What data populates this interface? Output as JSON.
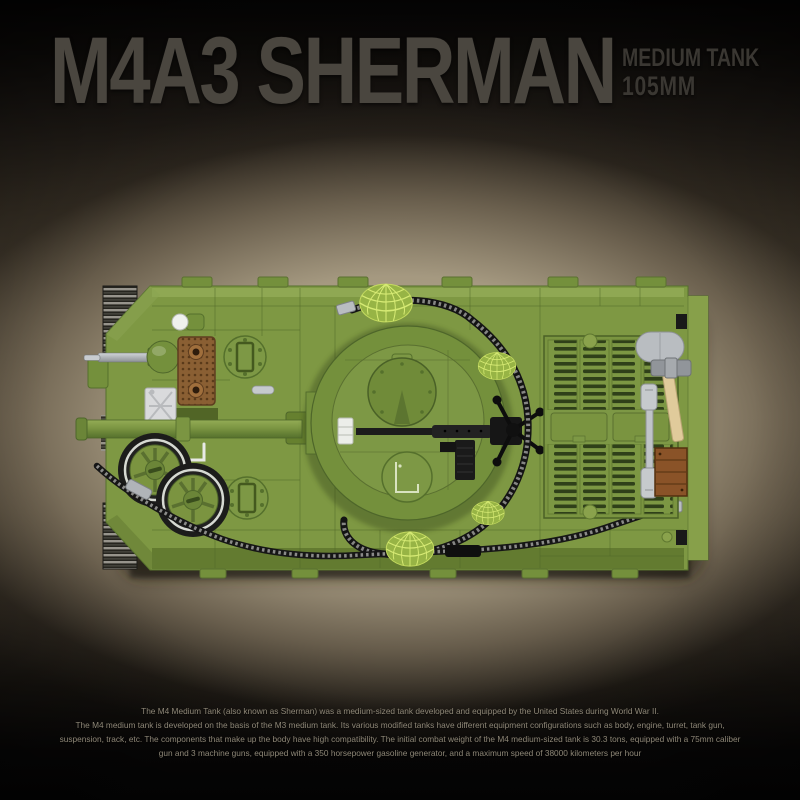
{
  "header": {
    "title": "M4A3 SHERMAN",
    "subtitle_line1": "MEDIUM TANK",
    "subtitle_line2": "105MM"
  },
  "description": {
    "lines": [
      "The M4 Medium Tank (also known as Sherman) was a medium-sized tank developed and equipped by the United States during World War II.",
      "The M4 medium tank is developed on the basis of the M3 medium tank. Its various modified tanks have different equipment configurations such as body, engine, turret, tank gun,",
      "suspension, track, etc. The components that make up the body have high compatibility. The initial combat weight of the M4 medium-sized tank is 30.3 tons, equipped with a 75mm caliber",
      "gun and 3 machine guns, equipped with a 350 horsepower gasoline generator, and a maximum speed of 38000 kilometers per hour"
    ]
  },
  "image": {
    "name": "tank-top-view",
    "subject": "Brick-built M4A3 Sherman tank, top-down view",
    "palette": {
      "hull_green": "#7e9843",
      "hull_green_light": "#93ab55",
      "hull_green_dark": "#55702c",
      "turret_green": "#74903c",
      "helmet_lime": "#a8c649",
      "grille_brown": "#8a5f33",
      "crate_brown": "#8a5328",
      "cable_black": "#161616",
      "metal_silver": "#b9bdc1",
      "hammer_handle_tan": "#e0cb9b",
      "jerrycan_white": "#d9dadc",
      "background_tan": "#a89c85",
      "background_dark": "#0a0908",
      "title_gray": "#4a463f"
    }
  }
}
